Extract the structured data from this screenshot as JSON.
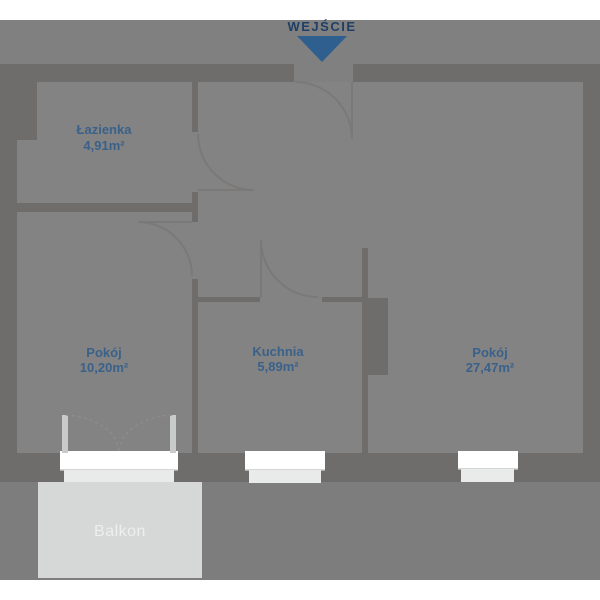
{
  "entrance": {
    "label": "WEJŚCIE"
  },
  "rooms": [
    {
      "key": "lazienka",
      "name": "Łazienka",
      "area": "4,91m²"
    },
    {
      "key": "pokoj-1",
      "name": "Pokój",
      "area": "10,20m²"
    },
    {
      "key": "kuchnia",
      "name": "Kuchnia",
      "area": "5,89m²"
    },
    {
      "key": "pokoj-2",
      "name": "Pokój",
      "area": "27,47m²"
    }
  ],
  "balcony": {
    "label": "Balkon"
  },
  "colors": {
    "background": "#ffffff",
    "site_gray": "#7d7d7d",
    "floor_gray": "#838383",
    "wall_gray": "#6f6d6b",
    "balcony_gray": "#d6d8d7",
    "window_white": "#ffffff",
    "window_sill": "#e9ebea",
    "door_line": "#7b7977",
    "entrance_text": "#1f3f66",
    "entrance_arrow": "#2e5f8e",
    "room_label": "#3a618a",
    "balcony_label": "#edefee"
  }
}
